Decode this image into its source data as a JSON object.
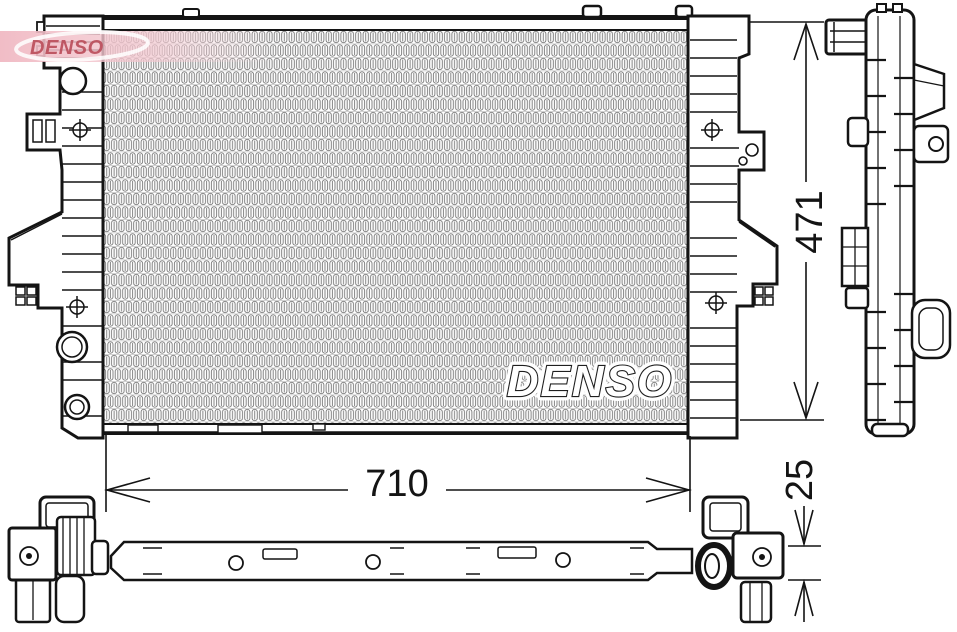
{
  "title": "DENSO radiator technical line drawing",
  "brand": {
    "logo_text": "DENSO",
    "watermark_text": "DENSO"
  },
  "dimensions": {
    "height": "471",
    "width": "710",
    "depth": "25"
  },
  "colors": {
    "line": "#141414",
    "fin_gray": "#787878",
    "logo_pink": "#f0b9c3",
    "logo_red": "#bb4f5c",
    "background": "#ffffff"
  }
}
